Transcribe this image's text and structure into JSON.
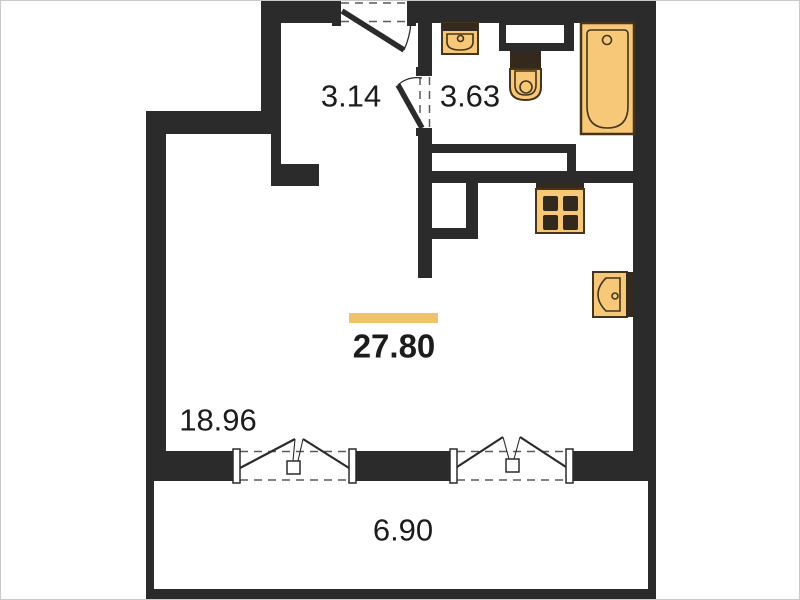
{
  "title": "studio apartment floor plan",
  "colors": {
    "wall": "#2b2b2b",
    "fixture_fill": "#f6c878",
    "fixture_stroke": "#45351c",
    "fixture_dark": "#33291c",
    "area_marker": "#efc36a",
    "label_text": "#1c1c1c",
    "background": "#ffffff",
    "frame": "#c9c9c9"
  },
  "rooms": {
    "hallway": {
      "area": "3.14"
    },
    "bathroom": {
      "area": "3.63"
    },
    "main": {
      "area": "27.80"
    },
    "living_zone": {
      "area": "18.96"
    },
    "balcony": {
      "area": "6.90"
    }
  },
  "fixtures": [
    "entry-door",
    "interior-door",
    "washbasin",
    "toilet",
    "bathtub",
    "duct-niche",
    "stove",
    "kitchen-sink",
    "window-left",
    "window-right"
  ]
}
